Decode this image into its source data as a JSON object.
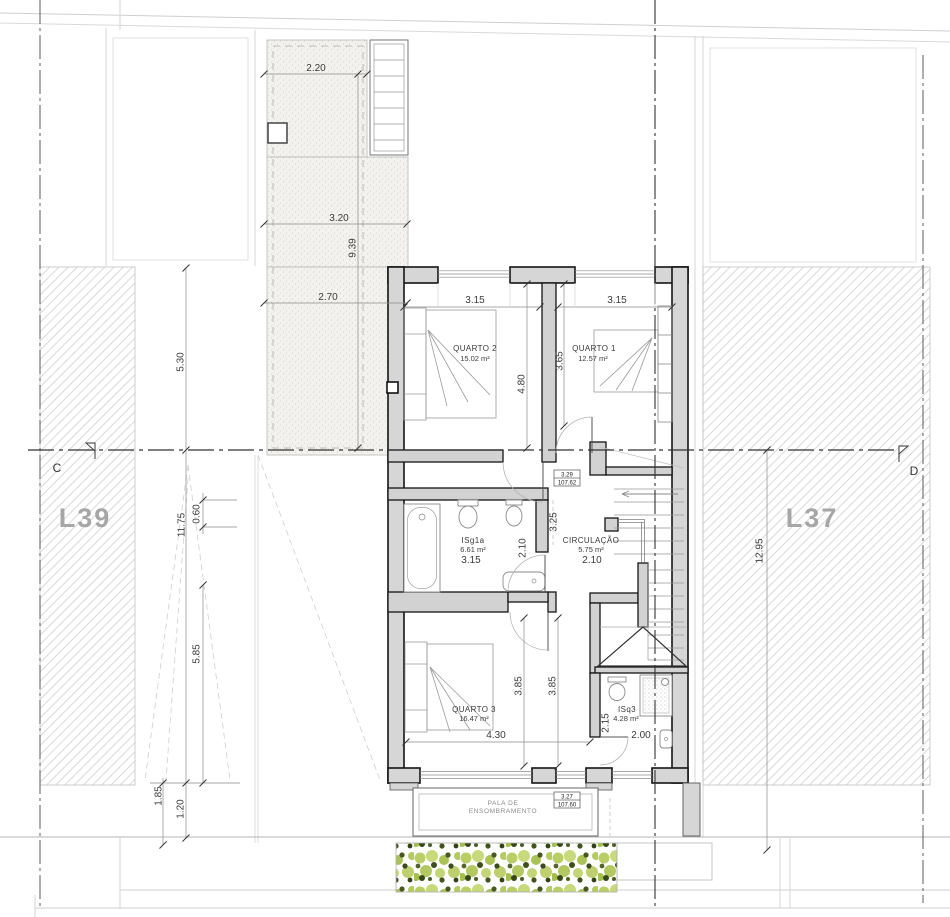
{
  "plan": {
    "lots": {
      "left": "L39",
      "right": "L37"
    },
    "section_markers": {
      "left": "C",
      "right": "D"
    },
    "rooms": {
      "quarto2": {
        "name": "QUARTO 2",
        "area": "15.02 m²",
        "width": "3.15",
        "height": "4.80"
      },
      "quarto1": {
        "name": "QUARTO 1",
        "area": "12.57 m²",
        "width": "3.15",
        "height": "3.65"
      },
      "isg1a": {
        "name": "ISg1a",
        "area": "6.61 m²",
        "width": "3.15",
        "height": "2.10"
      },
      "circulacao": {
        "name": "CIRCULAÇÃO",
        "area": "5.75 m²",
        "width": "2.10",
        "corridor": "3.25"
      },
      "quarto3": {
        "name": "QUARTO 3",
        "area": "16.47 m²",
        "width": "4.30",
        "height_left": "3.85",
        "height_right": "3.85"
      },
      "isq3": {
        "name": "ISq3",
        "area": "4.28 m²",
        "width": "2.00",
        "height": "2.15"
      }
    },
    "site_dims": {
      "terrace_top": "2.20",
      "terrace_mid": "3.20",
      "terrace_length": "9.39",
      "terrace_low": "2.70",
      "left_upper": "5.30",
      "left_total": "11.75",
      "left_inset": "0.60",
      "left_lower": "5.85",
      "bottom_a": "1.85",
      "bottom_b": "1.20",
      "right_total": "12.95"
    },
    "levels": {
      "stair": {
        "rel": "3.29",
        "abs": "107.62"
      },
      "pala": {
        "rel": "3.27",
        "abs": "107.60"
      }
    },
    "pala_label": {
      "line1": "PALA DE",
      "line2": "ENSOMBRAMENTO"
    }
  },
  "colors": {
    "wall_fill": "#d6d6d6",
    "wall_line": "#141414",
    "lot_label": "#a6a6a6",
    "hatch_line": "#cfcfcf",
    "stipple_dot": "#c6c2b6",
    "hedge_light": "#b9cf63",
    "hedge_dark": "#3c4c1a"
  }
}
